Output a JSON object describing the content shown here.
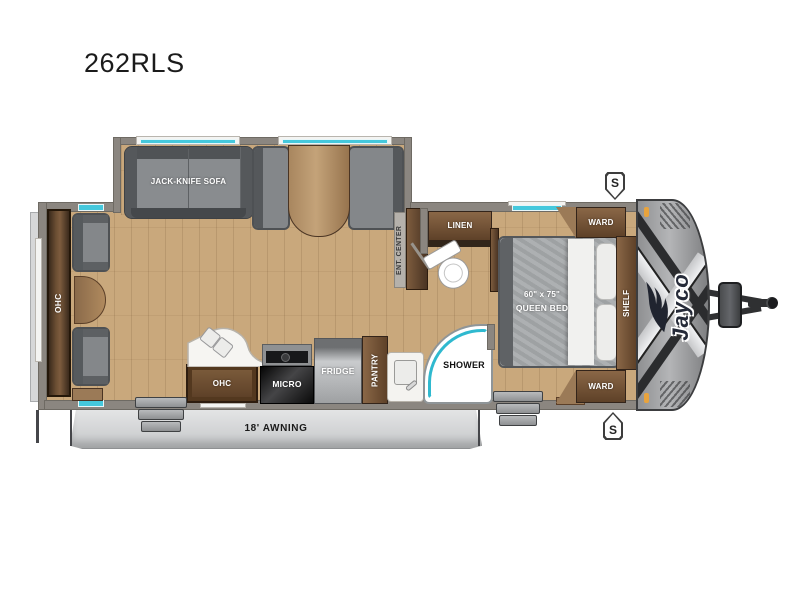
{
  "title": "262RLS",
  "brand": {
    "logo_text": "Jayco"
  },
  "exterior": {
    "awning_label": "18' AWNING",
    "speaker_top": "S",
    "speaker_bottom": "S"
  },
  "living": {
    "sofa_label": "JACK-KNIFE SOFA",
    "rear_ohc_label": "OHC",
    "ent_center_label": "ENT. CENTER"
  },
  "kitchen": {
    "ohc_label": "OHC",
    "micro_label": "MICRO",
    "fridge_label": "FRIDGE",
    "pantry_label": "PANTRY"
  },
  "bath": {
    "linen_label": "LINEN",
    "shower_label": "SHOWER"
  },
  "bedroom": {
    "bed_size": "60\" x 75\"",
    "bed_name": "QUEEN BED",
    "ward_top": "WARD",
    "ward_bottom": "WARD",
    "shelf_label": "SHELF"
  },
  "colors": {
    "window_teal": "#45c8dc",
    "floor_wood": "#c9a87c",
    "wall_gray": "#8b8680",
    "cabinet_brown": "#6f5138",
    "front_cap_gray": "#9fa1a3"
  }
}
